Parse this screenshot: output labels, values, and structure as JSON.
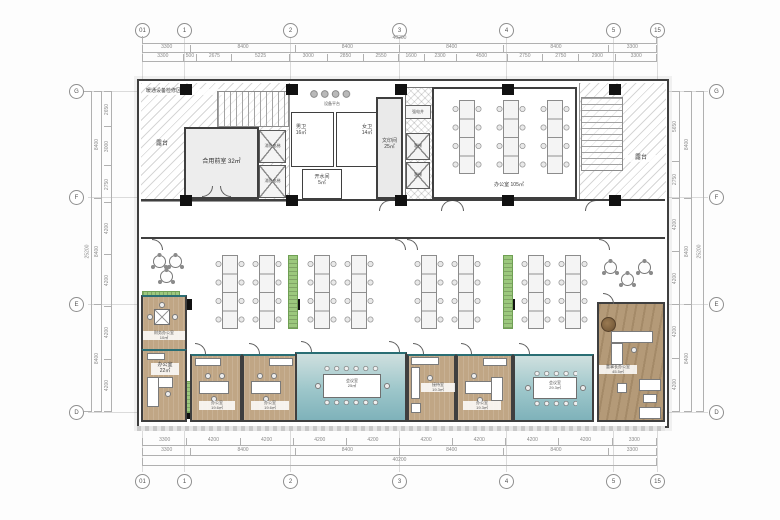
{
  "grid": {
    "top_bubbles": [
      "01",
      "1",
      "2",
      "3",
      "4",
      "5",
      "15"
    ],
    "bottom_bubbles": [
      "01",
      "1",
      "2",
      "3",
      "4",
      "5",
      "15"
    ],
    "left_bubbles": [
      "G",
      "F",
      "E",
      "D"
    ],
    "right_bubbles": [
      "G",
      "F",
      "E",
      "D"
    ],
    "top_total": [
      "40200"
    ],
    "top_major": [
      "3300",
      "8400",
      "8400",
      "8400",
      "8400",
      "3300"
    ],
    "top_detail": [
      "3300",
      "500",
      "2675",
      "5225",
      "3000",
      "2850",
      "2550",
      "1600",
      "2300",
      "4500",
      "2750",
      "2750",
      "2900",
      "3300"
    ],
    "bottom_detail": [
      "3300",
      "4200",
      "4200",
      "4200",
      "4200",
      "4200",
      "4200",
      "4200",
      "4200",
      "3300"
    ],
    "bottom_major": [
      "3300",
      "8400",
      "8400",
      "8400",
      "8400",
      "3300"
    ],
    "bottom_total": [
      "40200"
    ],
    "left_detail": [
      "2650",
      "3000",
      "2750",
      "4200",
      "4200",
      "4200",
      "4200"
    ],
    "left_major": [
      "8400",
      "8400",
      "8400"
    ],
    "left_total": [
      "25200"
    ],
    "right_detail": [
      "5650",
      "2750",
      "4200",
      "4200",
      "4200",
      "4200"
    ],
    "right_major": [
      "8400",
      "8400",
      "8400"
    ],
    "right_total": [
      "25200"
    ]
  },
  "rooms": {
    "hvac_zone": "暖通设备检修区域",
    "terrace_left": "露台",
    "terrace_right": "露台",
    "shared_front": "合用前室 32㎡",
    "fire_lift": "消防电梯",
    "mens": "男卫\n16㎡",
    "womens": "女卫\n14㎡",
    "equip_platform": "设备平台",
    "pantry": "开水间\n5㎡",
    "print": "文印间\n25㎡",
    "elec_shaft": "强电井",
    "lift": "客梯",
    "office_top": "办公室 105㎡",
    "finance": "财务办公室\n10㎡",
    "office22": "办公室\n22㎡",
    "office196": "办公室\n19.6㎡",
    "meeting25": "会议室\n25㎡",
    "reception": "接待室\n19.3㎡",
    "office193": "办公室\n19.3㎡",
    "meeting293": "会议室\n29.3㎡",
    "chairman": "董事长办公室\n45.5㎡"
  },
  "colors": {
    "wall": "#3f3f3f",
    "wood_floor": "#c0a685",
    "meeting_floor": "#8fc0c6",
    "cabinet_green": "#9cc87d",
    "accent_teal": "#2a6e74"
  }
}
